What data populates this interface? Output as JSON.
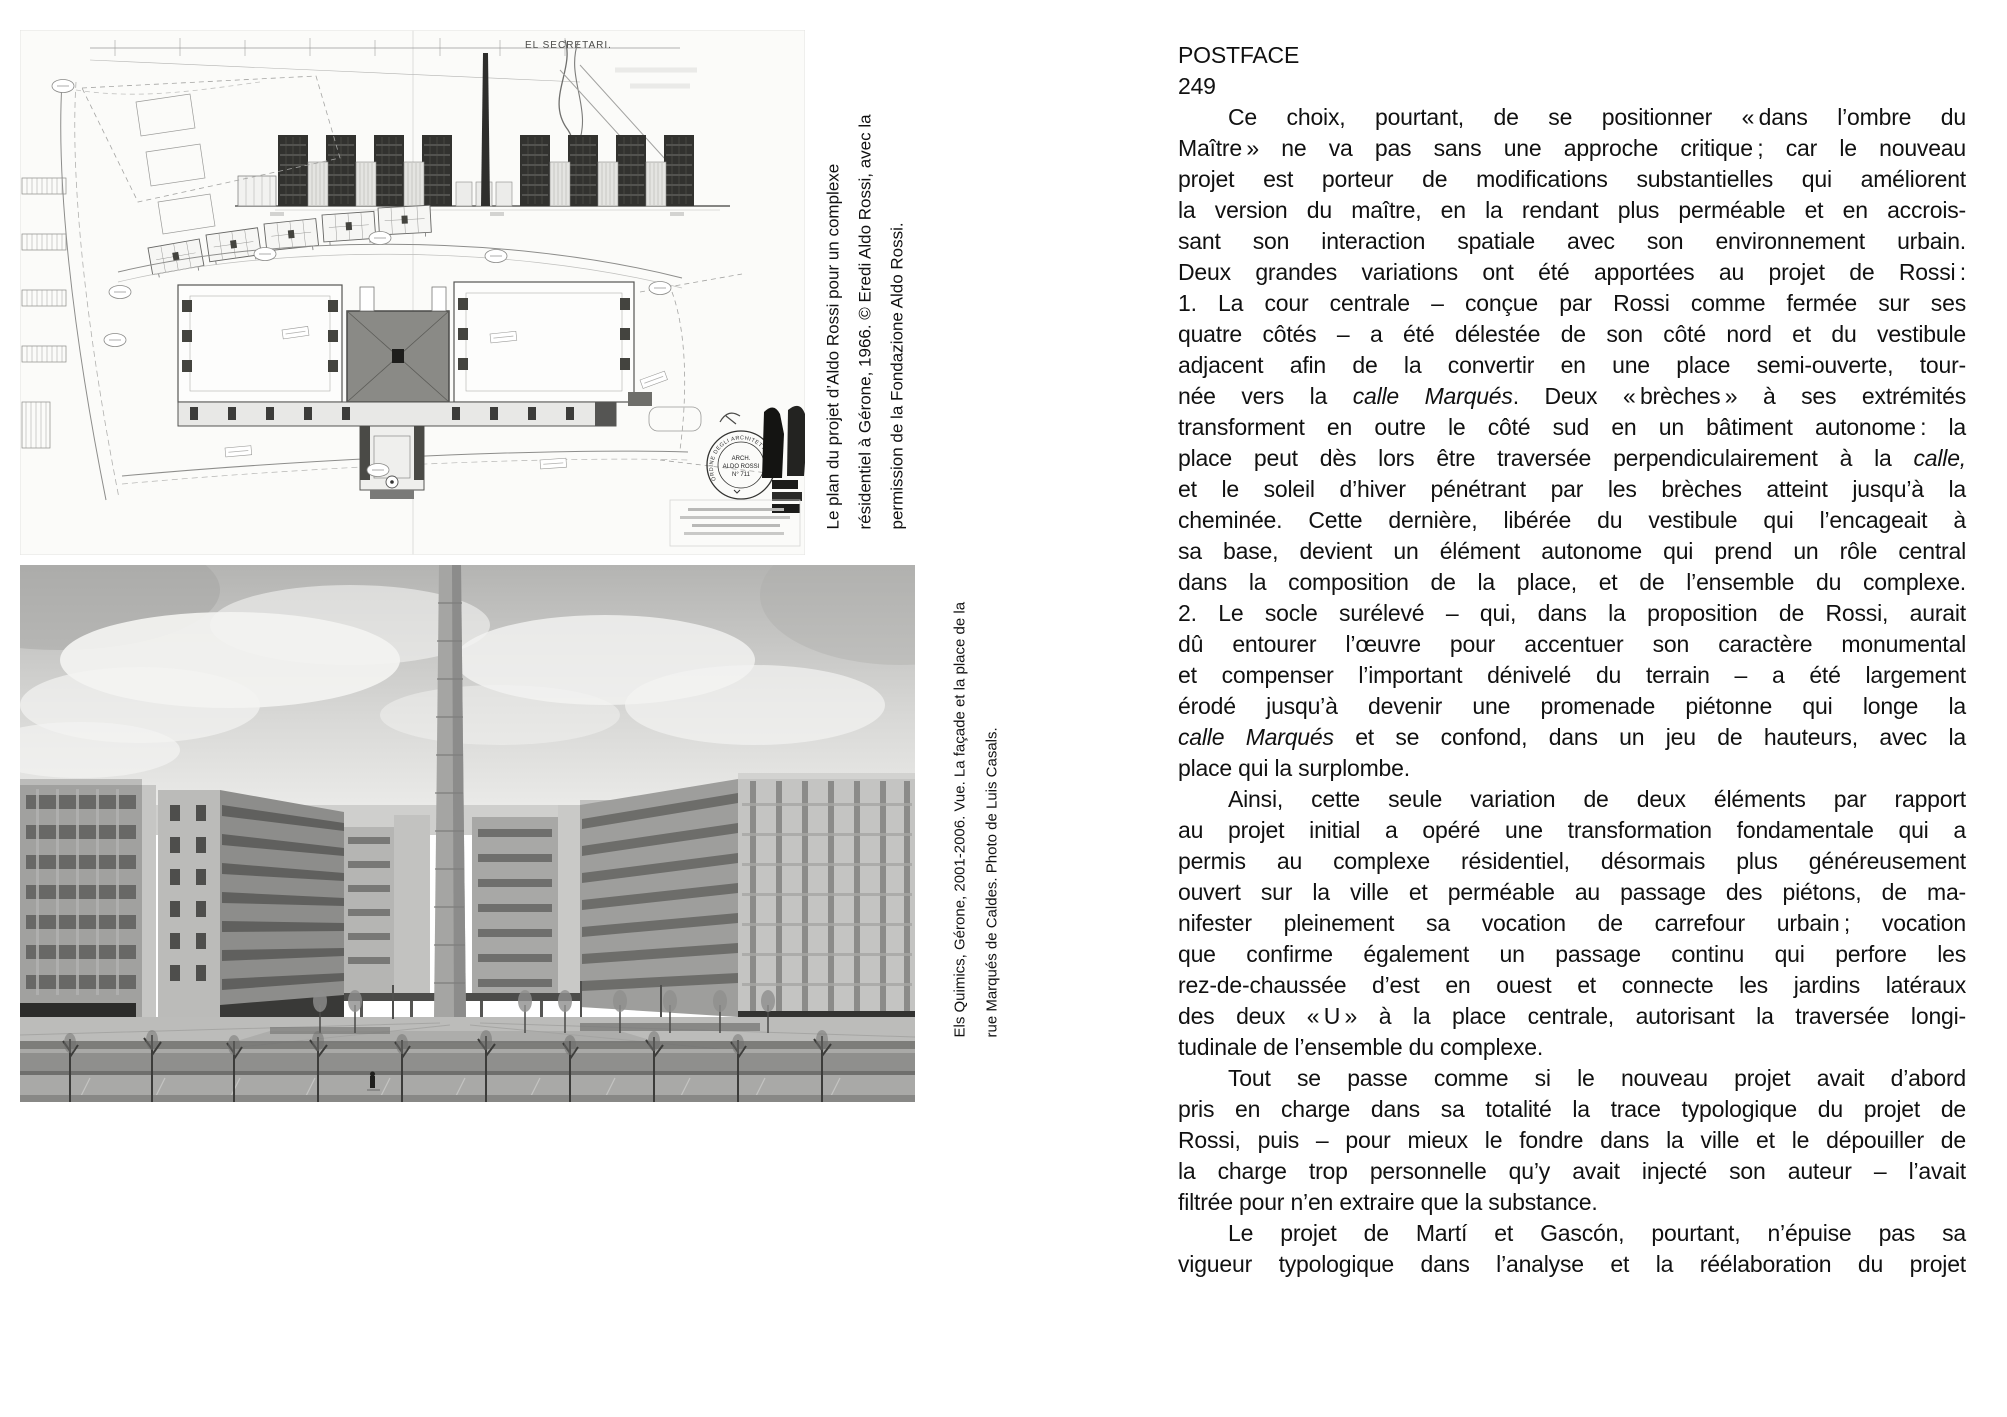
{
  "colors": {
    "paper": "#ffffff",
    "text": "#111111"
  },
  "figures": {
    "plan": {
      "caption": "Le plan du projet d’Aldo Rossi pour un complexe résidentiel à Gérone, 1966. © Eredi Aldo Rossi, avec la permission de la Fondazione Aldo Rossi.",
      "caption_lines": [
        "Le plan du projet d’Aldo Rossi pour un complexe",
        "résidentiel à Gérone, 1966. © Eredi Aldo Rossi, avec la",
        "permission de la Fondazione Aldo Rossi."
      ],
      "labels": {
        "secretari": "EL SECRETARI.",
        "stamp_ring": "ORDINE DEGLI ARCHITETTI",
        "stamp_line1": "ARCH.",
        "stamp_line2": "ALDO ROSSI",
        "stamp_line3": "N° 711"
      }
    },
    "photo": {
      "caption": "Els Quimics, Gérone, 2001-2006. Vue. La façade et la place de la rue Marqués de Caldes. Photo de Luis Casals.",
      "caption_lines": [
        "Els Quimics, Gérone, 2001-2006. Vue. La façade et la place de la",
        "rue Marqués de Caldes. Photo de Luis Casals."
      ]
    }
  },
  "article": {
    "title": "POSTFACE",
    "page_number": "249",
    "lines": [
      {
        "ind": true,
        "seg": [
          {
            "t": "Ce choix, pourtant, de se positionner « dans l’ombre du"
          }
        ]
      },
      {
        "seg": [
          {
            "t": "Maître » ne va pas sans une approche critique ; car le nouveau"
          }
        ]
      },
      {
        "seg": [
          {
            "t": "projet est porteur de modifications substantielles qui améliorent"
          }
        ]
      },
      {
        "seg": [
          {
            "t": "la version du maître, en la rendant plus perméable et en accrois-"
          }
        ]
      },
      {
        "seg": [
          {
            "t": "sant son interaction spatiale avec son environnement urbain."
          }
        ]
      },
      {
        "seg": [
          {
            "t": "Deux grandes variations ont été apportées au projet de Rossi :"
          }
        ]
      },
      {
        "seg": [
          {
            "t": "1. La cour centrale – conçue par Rossi comme fermée sur ses"
          }
        ]
      },
      {
        "seg": [
          {
            "t": "quatre côtés – a été délestée de son côté nord et du vestibule"
          }
        ]
      },
      {
        "seg": [
          {
            "t": "adjacent afin de la convertir en une place semi-ouverte, tour-"
          }
        ]
      },
      {
        "seg": [
          {
            "t": "née vers la "
          },
          {
            "t": "calle Marqués",
            "i": true
          },
          {
            "t": ". Deux « brèches » à ses extrémités"
          }
        ]
      },
      {
        "seg": [
          {
            "t": "transforment en outre le côté sud en un bâtiment autonome : la"
          }
        ]
      },
      {
        "seg": [
          {
            "t": "place peut dès lors être traversée perpendiculairement à la "
          },
          {
            "t": "calle,",
            "i": true
          }
        ]
      },
      {
        "seg": [
          {
            "t": "et le soleil d’hiver pénétrant par les brèches atteint jusqu’à la"
          }
        ]
      },
      {
        "seg": [
          {
            "t": "cheminée. Cette dernière, libérée du vestibule qui l’encageait à"
          }
        ]
      },
      {
        "seg": [
          {
            "t": "sa base, devient un élément autonome qui prend un rôle central"
          }
        ]
      },
      {
        "seg": [
          {
            "t": "dans la composition de la place, et de l’ensemble du complexe."
          }
        ]
      },
      {
        "seg": [
          {
            "t": "2. Le socle surélevé – qui, dans la proposition de Rossi, aurait"
          }
        ]
      },
      {
        "seg": [
          {
            "t": "dû entourer l’œuvre pour accentuer son caractère monumental"
          }
        ]
      },
      {
        "seg": [
          {
            "t": "et compenser l’important dénivelé du terrain – a été largement"
          }
        ]
      },
      {
        "seg": [
          {
            "t": "érodé jusqu’à devenir une promenade piétonne qui longe la"
          }
        ]
      },
      {
        "seg": [
          {
            "t": "calle Marqués",
            "i": true
          },
          {
            "t": " et se confond, dans un jeu de hauteurs, avec la"
          }
        ]
      },
      {
        "end": true,
        "seg": [
          {
            "t": "place qui la surplombe."
          }
        ]
      },
      {
        "ind": true,
        "seg": [
          {
            "t": "Ainsi, cette seule variation de deux éléments par rapport"
          }
        ]
      },
      {
        "seg": [
          {
            "t": "au projet initial a opéré une transformation fondamentale qui a"
          }
        ]
      },
      {
        "seg": [
          {
            "t": "permis au complexe résidentiel, désormais plus généreusement"
          }
        ]
      },
      {
        "seg": [
          {
            "t": "ouvert sur la ville et perméable au passage des piétons, de ma-"
          }
        ]
      },
      {
        "seg": [
          {
            "t": "nifester pleinement sa vocation de carrefour urbain ; vocation"
          }
        ]
      },
      {
        "seg": [
          {
            "t": "que confirme également un passage continu qui perfore les"
          }
        ]
      },
      {
        "seg": [
          {
            "t": "rez-de-chaussée d’est en ouest et connecte les jardins latéraux"
          }
        ]
      },
      {
        "seg": [
          {
            "t": "des deux « U » à la place centrale, autorisant la traversée longi-"
          }
        ]
      },
      {
        "end": true,
        "seg": [
          {
            "t": "tudinale de l’ensemble du complexe."
          }
        ]
      },
      {
        "ind": true,
        "seg": [
          {
            "t": "Tout se passe comme si le nouveau projet avait d’abord"
          }
        ]
      },
      {
        "seg": [
          {
            "t": "pris en charge dans sa totalité la trace typologique du projet de"
          }
        ]
      },
      {
        "seg": [
          {
            "t": "Rossi, puis – pour mieux le fondre dans la ville et le dépouiller de"
          }
        ]
      },
      {
        "seg": [
          {
            "t": "la charge trop personnelle qu’y avait injecté son auteur – l’avait"
          }
        ]
      },
      {
        "end": true,
        "seg": [
          {
            "t": "filtrée pour n’en extraire que la substance."
          }
        ]
      },
      {
        "ind": true,
        "seg": [
          {
            "t": "Le projet de Martí et Gascón, pourtant, n’épuise pas sa"
          }
        ]
      },
      {
        "seg": [
          {
            "t": "vigueur typologique dans l’analyse et la réélaboration du projet"
          }
        ]
      }
    ]
  }
}
